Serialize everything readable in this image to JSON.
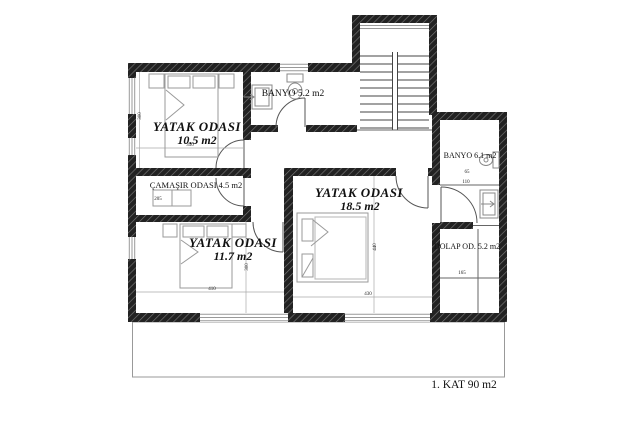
{
  "rooms": {
    "bedroom1": {
      "name": "YATAK ODASI",
      "area": "10.5 m2"
    },
    "bathroom1": {
      "name": "BANYO 5.2 m2"
    },
    "laundry": {
      "name": "ÇAMAŞIR ODASI 4.5 m2"
    },
    "bedroom2": {
      "name": "YATAK ODASI",
      "area": "11.7 m2"
    },
    "bedroom3": {
      "name": "YATAK ODASI",
      "area": "18.5 m2"
    },
    "bathroom2": {
      "name": "BANYO 6.1 m2"
    },
    "closet": {
      "name": "DOLAP OD. 5.2 m2"
    }
  },
  "floor_label": "1. KAT 90 m2",
  "dimensions": {
    "bedroom1_depth": "300",
    "bedroom1_width": "350",
    "laundry_width": "205",
    "bedroom2_width": "410",
    "bedroom2_depth": "300",
    "bedroom3_depth": "440",
    "bedroom3_width": "430",
    "bathroom2_a": "65",
    "bathroom2_b": "110",
    "closet_a": "165"
  },
  "colors": {
    "wall": "#222222",
    "hatch_line": "#777777",
    "partition": "#666666",
    "window": "#999999",
    "furniture": "#9a9a9a",
    "text": "#111111"
  }
}
